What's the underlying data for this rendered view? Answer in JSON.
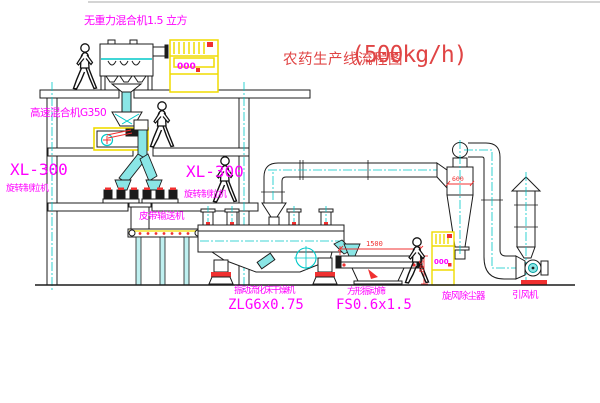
{
  "colors": {
    "line": "#1c1c1c",
    "centerline_cyan": "#00c8c8",
    "pipe_fill_cyan": "#8ae6e6",
    "cad_yellow": "#f0dc00",
    "cad_magenta": "#ff00ff",
    "cad_red": "#f03030",
    "title_red": "#d94545",
    "background": "#ffffff"
  },
  "title": {
    "name": "农药生产线流程图",
    "capacity": "(500kg/h)"
  },
  "equipment_labels": {
    "gravity_mixer": "无重力混合机1.5 立方",
    "high_speed_mixer": "高速混合机G350",
    "granulator_left": {
      "model": "XL-300",
      "name": "旋转制粒机"
    },
    "granulator_right": {
      "model": "XL-300",
      "name": "旋转制粒机"
    },
    "belt_conveyor": "皮带输送机",
    "fluid_bed_dryer": {
      "name": "振动流化床干燥机",
      "model": "ZLG6x0.75"
    },
    "vibrating_screen": {
      "name": "方形振动筛",
      "model": "FS0.6x1.5"
    },
    "cyclone": "旋风除尘器",
    "induced_draft_fan": "引风机"
  },
  "dimensions": {
    "screen_length": "1500",
    "screen_height": "540",
    "cyclone_body": "600"
  },
  "control_cabinet": {
    "display": "000"
  }
}
